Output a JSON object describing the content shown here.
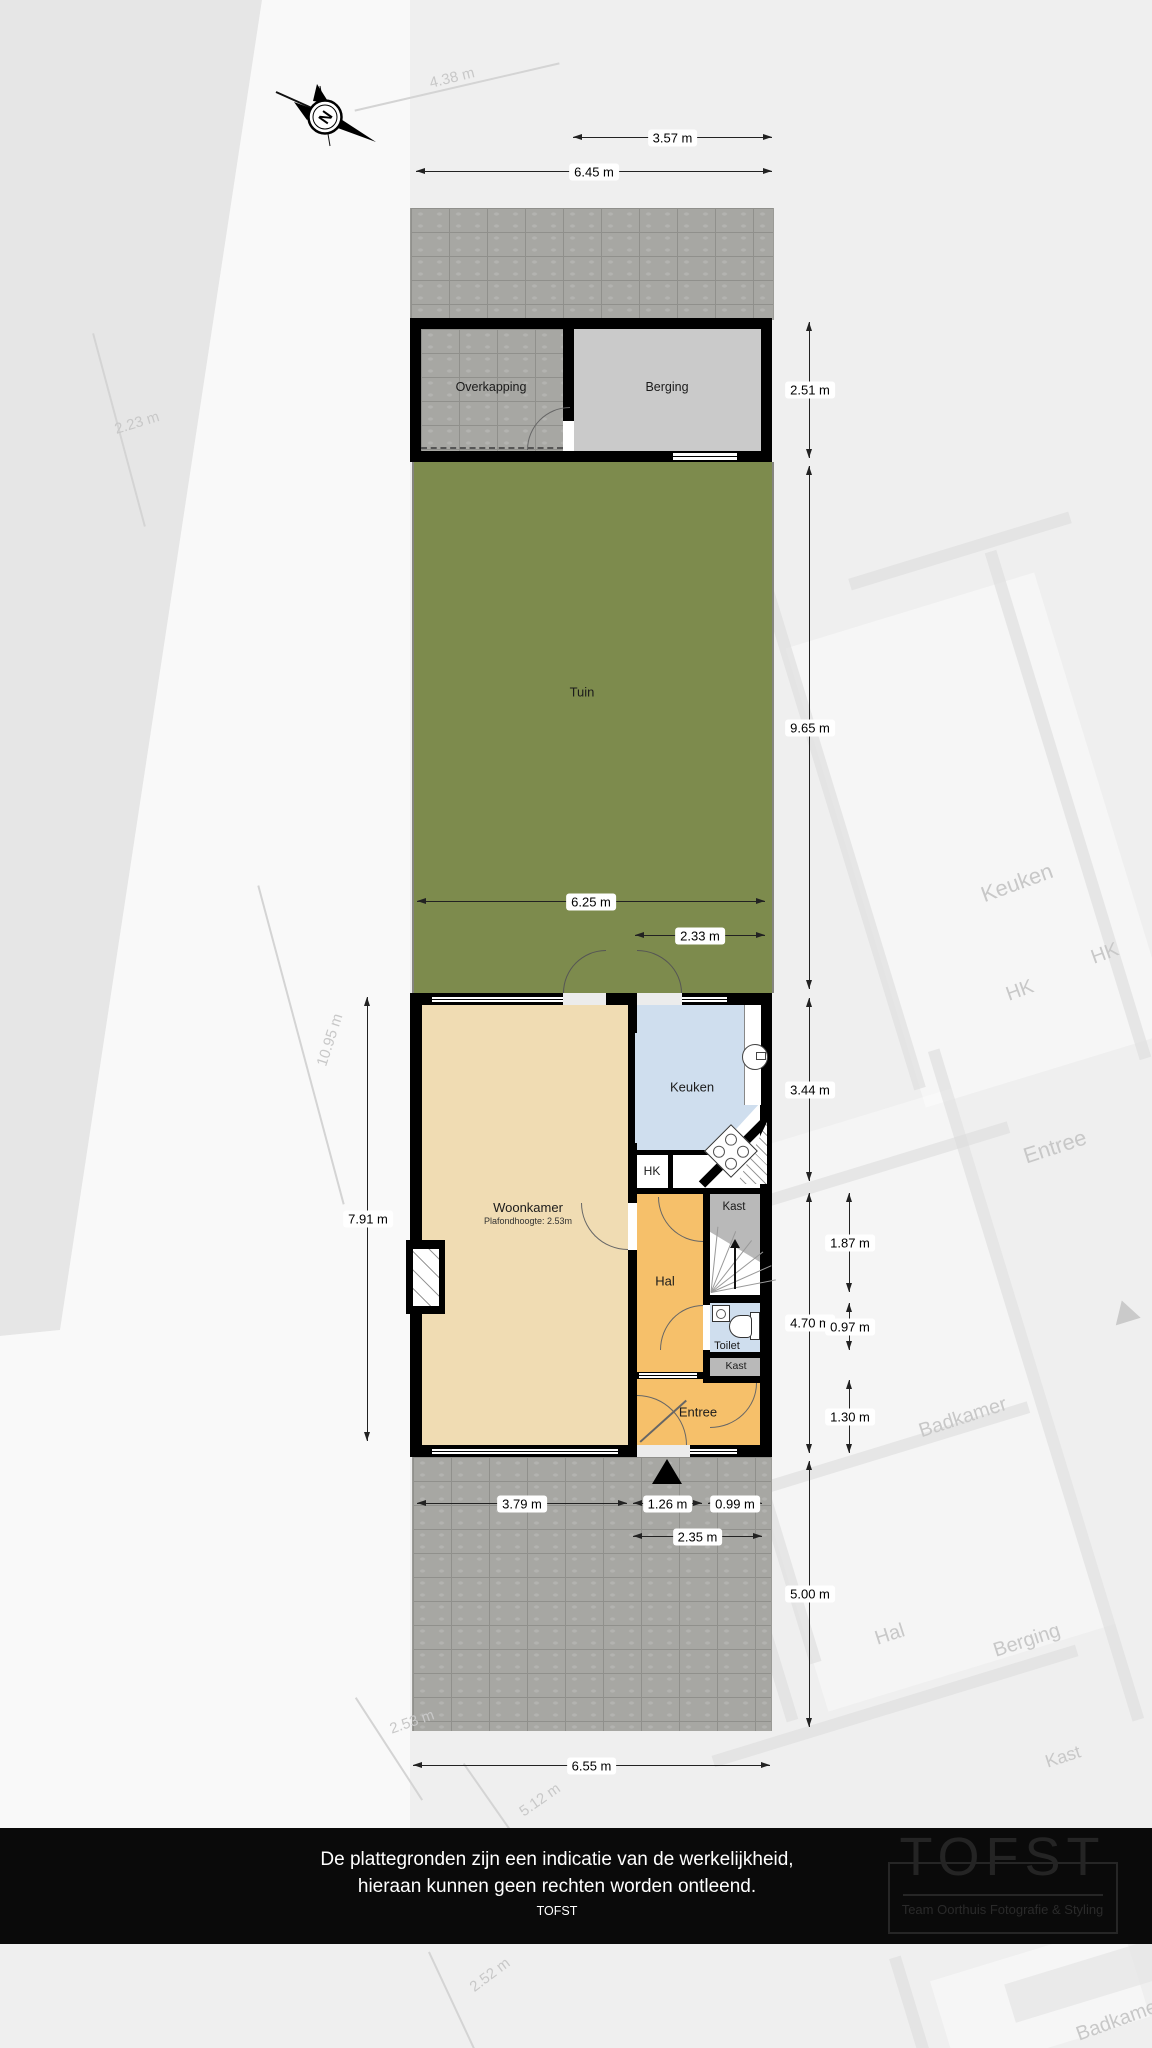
{
  "compass": {
    "label": "N"
  },
  "areas": {
    "overkapping": "Overkapping",
    "berging": "Berging",
    "tuin": "Tuin",
    "woonkamer": "Woonkamer",
    "woonkamer_sub": "Plafondhoogte: 2.53m",
    "keuken": "Keuken",
    "hk": "HK",
    "hal": "Hal",
    "kast_boven": "Kast",
    "toilet": "Toilet",
    "kast_onder": "Kast",
    "entree": "Entree"
  },
  "dimensions": {
    "horizontal": [
      {
        "label": "3.57 m",
        "x1": 573,
        "x2": 772,
        "y": 138
      },
      {
        "label": "6.45 m",
        "x1": 416,
        "x2": 772,
        "y": 172
      },
      {
        "label": "6.25 m",
        "x1": 417,
        "x2": 765,
        "y": 902
      },
      {
        "label": "2.33 m",
        "x1": 635,
        "x2": 765,
        "y": 936
      },
      {
        "label": "3.79 m",
        "x1": 417,
        "x2": 627,
        "y": 1504
      },
      {
        "label": "1.26 m",
        "x1": 633,
        "x2": 702,
        "y": 1504
      },
      {
        "label": "0.99 m",
        "x1": 708,
        "x2": 762,
        "y": 1504
      },
      {
        "label": "2.35 m",
        "x1": 633,
        "x2": 762,
        "y": 1537
      },
      {
        "label": "6.55 m",
        "x1": 413,
        "x2": 770,
        "y": 1766
      }
    ],
    "vertical": [
      {
        "label": "2.51 m",
        "y1": 322,
        "y2": 458,
        "x": 810
      },
      {
        "label": "9.65 m",
        "y1": 466,
        "y2": 989,
        "x": 810
      },
      {
        "label": "3.44 m",
        "y1": 998,
        "y2": 1181,
        "x": 810
      },
      {
        "label": "7.91 m",
        "y1": 997,
        "y2": 1441,
        "x": 368
      },
      {
        "label": "1.87 m",
        "y1": 1193,
        "y2": 1292,
        "x": 850
      },
      {
        "label": "4.70 m",
        "y1": 1193,
        "y2": 1453,
        "x": 810
      },
      {
        "label": "0.97 m",
        "y1": 1303,
        "y2": 1350,
        "x": 850
      },
      {
        "label": "1.30 m",
        "y1": 1380,
        "y2": 1453,
        "x": 850
      },
      {
        "label": "5.00 m",
        "y1": 1461,
        "y2": 1727,
        "x": 810
      }
    ]
  },
  "backdrop_labels": [
    {
      "text": "4.38 m",
      "x": 452,
      "y": 78,
      "rot": -14,
      "size": 15
    },
    {
      "text": "2.23 m",
      "x": 137,
      "y": 423,
      "rot": -17,
      "size": 15
    },
    {
      "text": "Keuken",
      "x": 1017,
      "y": 883,
      "rot": -20,
      "size": 22
    },
    {
      "text": "HK",
      "x": 1105,
      "y": 954,
      "rot": -20,
      "size": 20
    },
    {
      "text": "HK",
      "x": 1020,
      "y": 991,
      "rot": -20,
      "size": 20
    },
    {
      "text": "Entree",
      "x": 1055,
      "y": 1147,
      "rot": -18,
      "size": 22
    },
    {
      "text": "10.95 m",
      "x": 330,
      "y": 1040,
      "rot": -72,
      "size": 15
    },
    {
      "text": "Badkamer",
      "x": 963,
      "y": 1418,
      "rot": -18,
      "size": 20
    },
    {
      "text": "Hal",
      "x": 890,
      "y": 1635,
      "rot": -18,
      "size": 20
    },
    {
      "text": "Berging",
      "x": 1027,
      "y": 1641,
      "rot": -18,
      "size": 20
    },
    {
      "text": "Kast",
      "x": 1063,
      "y": 1757,
      "rot": -18,
      "size": 18
    },
    {
      "text": "2.53 m",
      "x": 412,
      "y": 1722,
      "rot": -19,
      "size": 15
    },
    {
      "text": "5.12 m",
      "x": 540,
      "y": 1800,
      "rot": -35,
      "size": 15
    },
    {
      "text": "2.52 m",
      "x": 490,
      "y": 1975,
      "rot": -37,
      "size": 15
    },
    {
      "text": "Badkamer",
      "x": 1120,
      "y": 2020,
      "rot": -20,
      "size": 20
    }
  ],
  "footer": {
    "line1": "De plattegronden zijn een indicatie van de werkelijkheid,",
    "line2": "hieraan kunnen geen rechten worden ontleend.",
    "line3": "TOFST"
  },
  "logo": {
    "word": "TOFST",
    "subtitle": "Team Oorthuis Fotografie & Styling"
  },
  "colors": {
    "wall": "#000000",
    "garden": "#7d8b4d",
    "paving": "#a7a7a3",
    "woonkamer_floor": "#f0dcb3",
    "hal_floor": "#f6c06a",
    "keuken_floor": "#cfdeee",
    "kast_floor": "#b9b9b9",
    "berging_floor": "#cacaca",
    "footer_bg": "#0a0a0a"
  }
}
